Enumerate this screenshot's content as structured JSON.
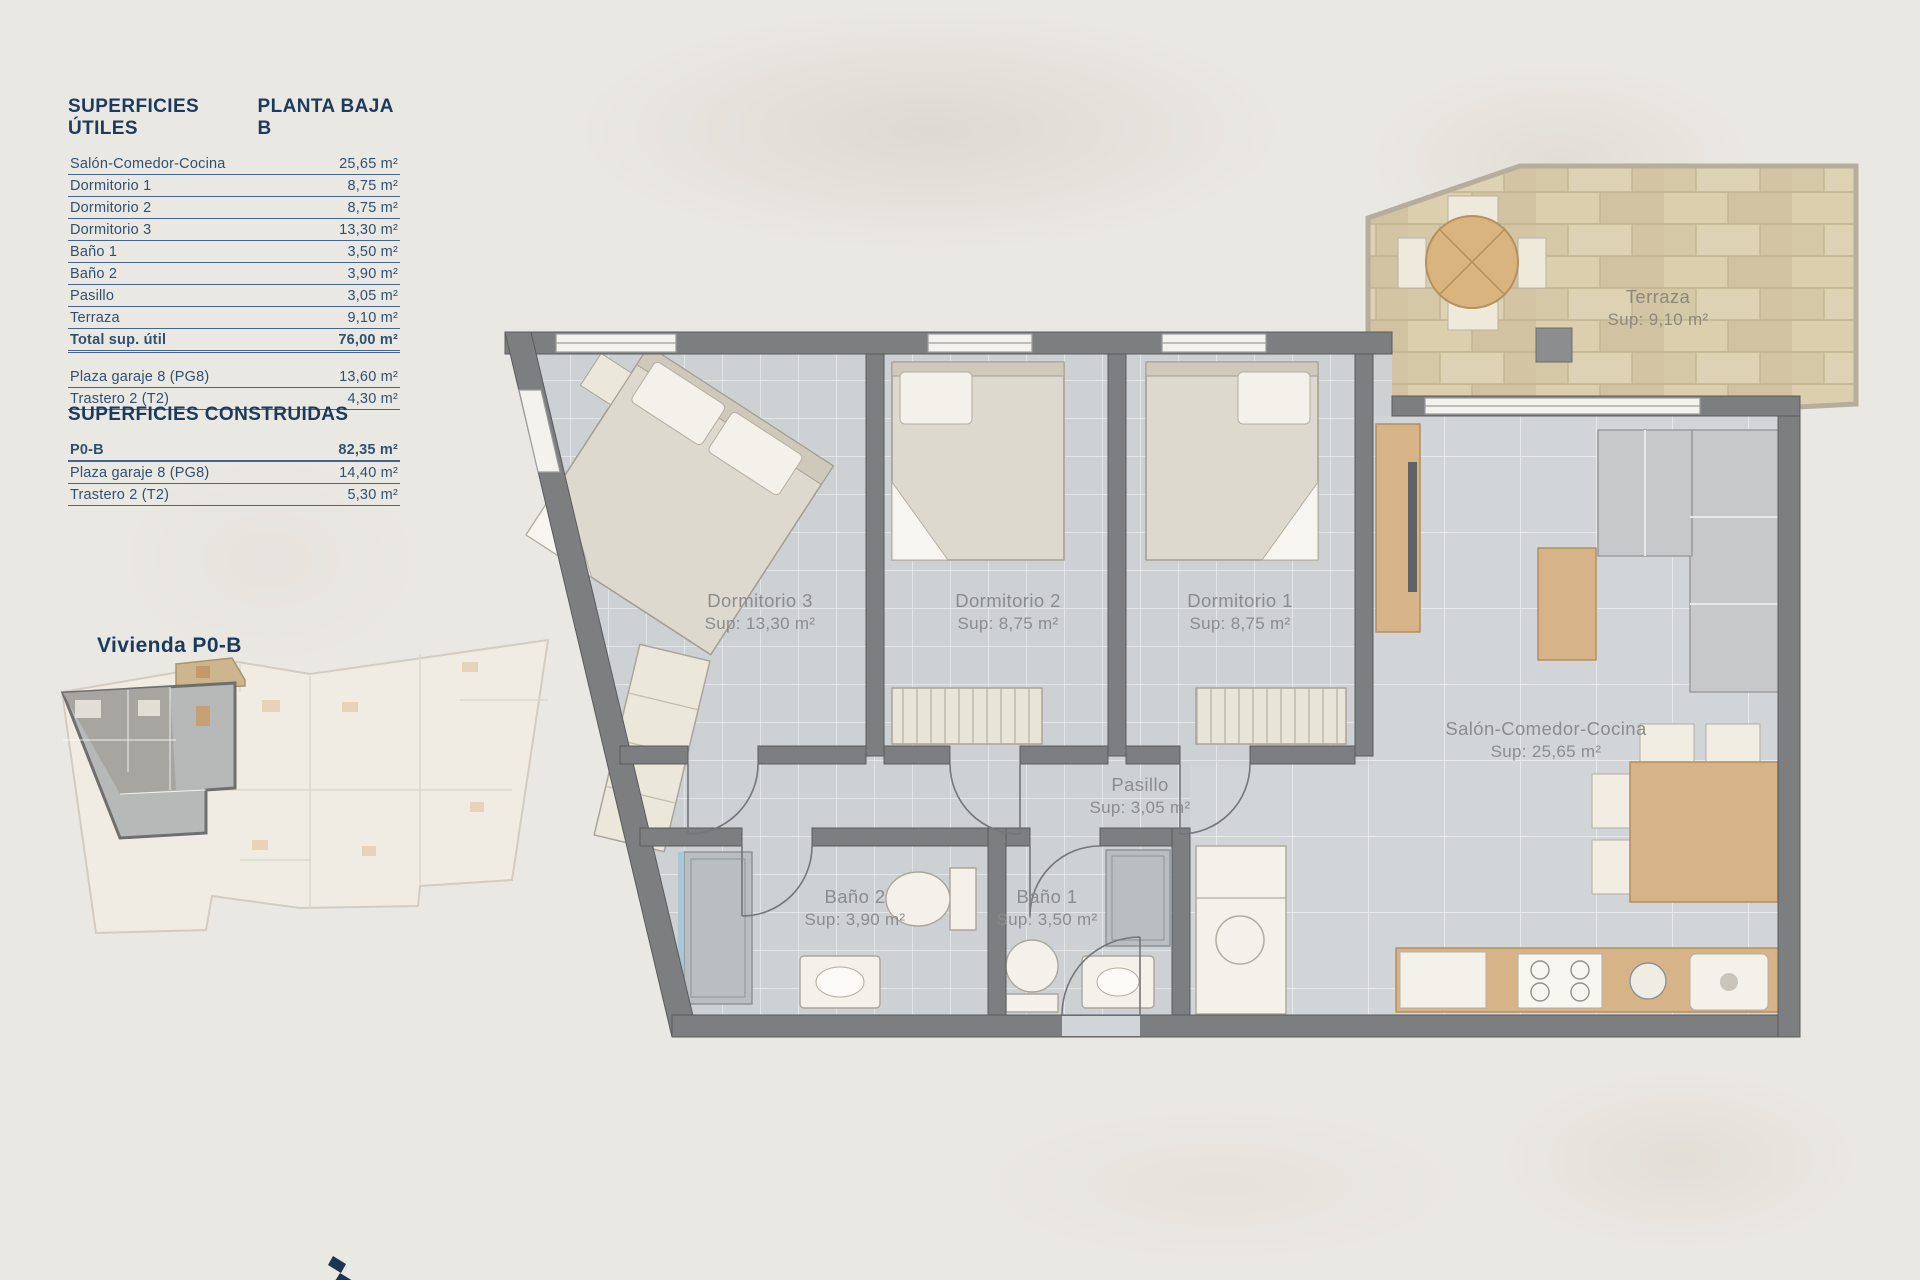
{
  "document": {
    "background_color": "#eae8e3",
    "accent_color": "#1c3a5c",
    "floor_tile_color": "#cdd1d4",
    "wall_color": "#7c7e80",
    "terrace_stone_color": "#d8cbaa",
    "wood_color": "#d7b388"
  },
  "superficies_utiles": {
    "title": "SUPERFICIES ÚTILES",
    "plan_title": "PLANTA BAJA B",
    "rows": [
      {
        "label": "Salón-Comedor-Cocina",
        "value": "25,65 m²"
      },
      {
        "label": "Dormitorio 1",
        "value": "8,75 m²"
      },
      {
        "label": "Dormitorio 2",
        "value": "8,75 m²"
      },
      {
        "label": "Dormitorio 3",
        "value": "13,30 m²"
      },
      {
        "label": "Baño 1",
        "value": "3,50 m²"
      },
      {
        "label": "Baño 2",
        "value": "3,90 m²"
      },
      {
        "label": "Pasillo",
        "value": "3,05 m²"
      },
      {
        "label": "Terraza",
        "value": "9,10 m²"
      }
    ],
    "total": {
      "label": "Total sup. útil",
      "value": "76,00 m²"
    },
    "annex_rows": [
      {
        "label": "Plaza garaje 8 (PG8)",
        "value": "13,60 m²"
      },
      {
        "label": "Trastero 2 (T2)",
        "value": "4,30 m²"
      }
    ]
  },
  "superficies_construidas": {
    "title": "SUPERFICIES CONSTRUIDAS",
    "rows": [
      {
        "label": "P0-B",
        "value": "82,35 m²"
      },
      {
        "label": "Plaza garaje 8 (PG8)",
        "value": "14,40 m²"
      },
      {
        "label": "Trastero 2 (T2)",
        "value": "5,30 m²"
      }
    ]
  },
  "key_plan": {
    "title": "Vivienda P0-B"
  },
  "floor_plan": {
    "rooms": [
      {
        "name": "Terraza",
        "sup": "Sup: 9,10 m²"
      },
      {
        "name": "Dormitorio 3",
        "sup": "Sup: 13,30 m²"
      },
      {
        "name": "Dormitorio 2",
        "sup": "Sup: 8,75 m²"
      },
      {
        "name": "Dormitorio 1",
        "sup": "Sup: 8,75 m²"
      },
      {
        "name": "Salón-Comedor-Cocina",
        "sup": "Sup: 25,65 m²"
      },
      {
        "name": "Pasillo",
        "sup": "Sup: 3,05 m²"
      },
      {
        "name": "Baño 2",
        "sup": "Sup: 3,90 m²"
      },
      {
        "name": "Baño 1",
        "sup": "Sup: 3,50 m²"
      }
    ]
  }
}
